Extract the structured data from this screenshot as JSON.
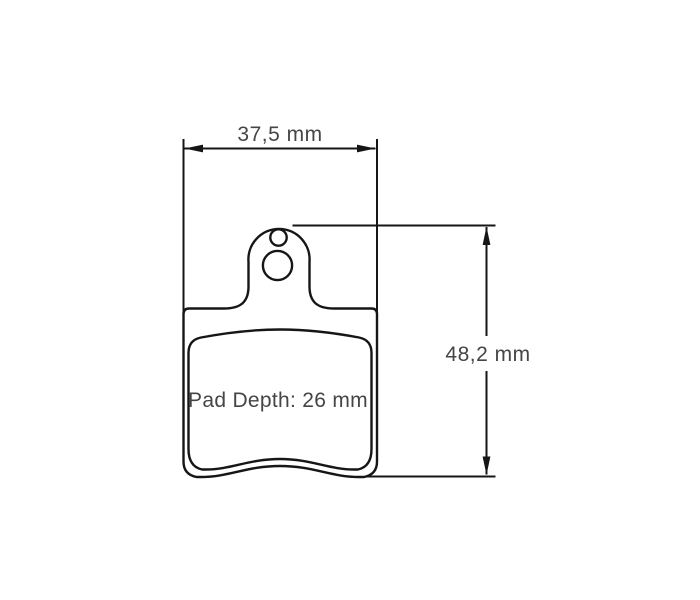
{
  "canvas": {
    "background": "#ffffff"
  },
  "colors": {
    "line": "#161616",
    "text": "#454545"
  },
  "diagram": {
    "type": "technical-drawing",
    "subject": "brake-pad-with-mounting-tab-and-two-holes",
    "dimensions": {
      "width_label": "37,5 mm",
      "width_value_mm": 37.5,
      "height_label": "48,2 mm",
      "height_value_mm": 48.2,
      "pad_depth_label": "Pad Depth: 26 mm",
      "pad_depth_value_mm": 26
    }
  }
}
